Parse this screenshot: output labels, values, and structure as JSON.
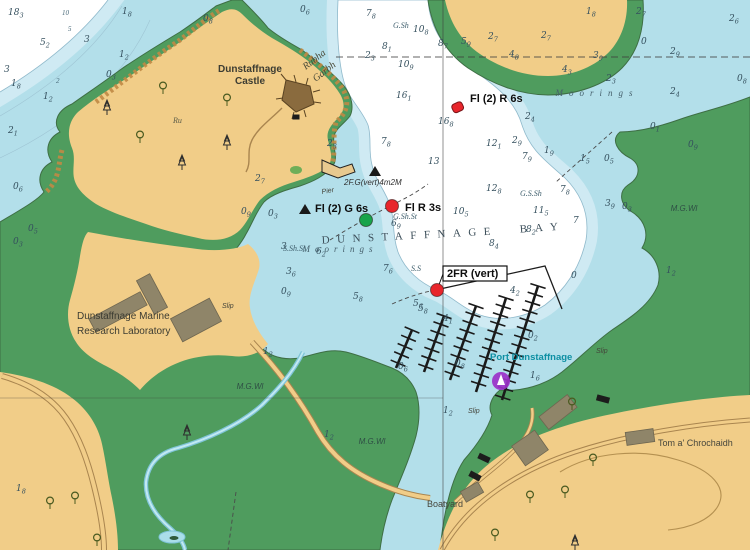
{
  "map": {
    "name": "Dunstaffnage Bay nautical chart",
    "colors": {
      "water_shallow": "#b3dfea",
      "water_band": "#cfeaf3",
      "water_deep": "#ffffff",
      "land_green": "#4f9c5e",
      "land_tan": "#f1cd88",
      "building_grey": "#8f8569",
      "building_black": "#1c1c1c",
      "buoy_red": "#e8262c",
      "buoy_green": "#18a44a",
      "marina_purple": "#9b30c8",
      "port_label_teal": "#0d8fa3",
      "road_brown": "#a9854f",
      "stream_blue": "#7fc4d8"
    },
    "labels": [
      {
        "t": "Dunstaffnage",
        "x": 250,
        "y": 72,
        "cls": "place",
        "anchor": "middle"
      },
      {
        "t": "Castle",
        "x": 250,
        "y": 84,
        "cls": "place",
        "anchor": "middle"
      },
      {
        "t": "Rubha",
        "x": 316,
        "y": 62,
        "cls": "ital",
        "anchor": "middle",
        "rot": -38
      },
      {
        "t": "Garbh",
        "x": 326,
        "y": 74,
        "cls": "ital",
        "anchor": "middle",
        "rot": -38
      },
      {
        "t": "Ru",
        "x": 173,
        "y": 123,
        "cls": "ital-sm"
      },
      {
        "t": "Dunstaffnage Marine",
        "x": 77,
        "y": 319,
        "cls": "place-l"
      },
      {
        "t": "Research Laboratory",
        "x": 77,
        "y": 334,
        "cls": "place-l"
      },
      {
        "t": "Moorings",
        "x": 597,
        "y": 96,
        "cls": "moor",
        "anchor": "middle",
        "ls": 6
      },
      {
        "t": "Moorings",
        "x": 340,
        "y": 252,
        "cls": "moor",
        "anchor": "middle",
        "ls": 5
      },
      {
        "t": "DUNSTAFFNAGE",
        "x": 410,
        "y": 239,
        "cls": "bay",
        "anchor": "middle",
        "ls": 7.5,
        "rot": -3
      },
      {
        "t": "BAY",
        "x": 543,
        "y": 231,
        "cls": "bay",
        "anchor": "middle",
        "ls": 8,
        "rot": -4
      },
      {
        "t": "M.G.Wl",
        "x": 250,
        "y": 389,
        "cls": "note",
        "anchor": "middle"
      },
      {
        "t": "M.G.Wl",
        "x": 372,
        "y": 444,
        "cls": "note",
        "anchor": "middle"
      },
      {
        "t": "M.G.Wl",
        "x": 684,
        "y": 211,
        "cls": "note",
        "anchor": "middle"
      },
      {
        "t": "Slip",
        "x": 222,
        "y": 308,
        "cls": "tiny"
      },
      {
        "t": "Slip",
        "x": 468,
        "y": 413,
        "cls": "tiny"
      },
      {
        "t": "Slip",
        "x": 596,
        "y": 353,
        "cls": "tiny"
      },
      {
        "t": "Boatyard",
        "x": 427,
        "y": 507,
        "cls": "place-s"
      },
      {
        "t": "Tom a' Chrochaidh",
        "x": 658,
        "y": 446,
        "cls": "place-s"
      },
      {
        "t": "Port Dunstaffnage",
        "x": 490,
        "y": 360,
        "cls": "port"
      },
      {
        "t": "Pier",
        "x": 322,
        "y": 194,
        "cls": "tiny",
        "rot": -10
      },
      {
        "t": "2F.G(vert)4m2M",
        "x": 344,
        "y": 185,
        "cls": "lightchar"
      },
      {
        "t": "G.Sh",
        "x": 393,
        "y": 28,
        "cls": "note-i"
      },
      {
        "t": "G.S.Sh",
        "x": 520,
        "y": 196,
        "cls": "note-i"
      },
      {
        "t": "G.Sh.St",
        "x": 393,
        "y": 219,
        "cls": "note-i"
      },
      {
        "t": "S.Sh.St",
        "x": 283,
        "y": 251,
        "cls": "note-i"
      },
      {
        "t": "S.S",
        "x": 411,
        "y": 271,
        "cls": "note-i"
      },
      {
        "t": "10",
        "x": 62,
        "y": 15,
        "cls": "cont"
      },
      {
        "t": "5",
        "x": 68,
        "y": 31,
        "cls": "cont"
      },
      {
        "t": "2",
        "x": 56,
        "y": 83,
        "cls": "cont"
      }
    ],
    "soundings": [
      {
        "x": 8,
        "y": 15,
        "v": "18",
        "s": "3"
      },
      {
        "x": 122,
        "y": 14,
        "v": "1",
        "s": "8"
      },
      {
        "x": 40,
        "y": 45,
        "v": "5",
        "s": "2"
      },
      {
        "x": 84,
        "y": 42,
        "v": "3",
        "s": ""
      },
      {
        "x": 119,
        "y": 57,
        "v": "1",
        "s": "2"
      },
      {
        "x": 4,
        "y": 72,
        "v": "3",
        "s": ""
      },
      {
        "x": 11,
        "y": 86,
        "v": "1",
        "s": "8"
      },
      {
        "x": 106,
        "y": 77,
        "v": "0",
        "s": "3"
      },
      {
        "x": 43,
        "y": 99,
        "v": "1",
        "s": "2"
      },
      {
        "x": 8,
        "y": 133,
        "v": "2",
        "s": "1"
      },
      {
        "x": 13,
        "y": 189,
        "v": "0",
        "s": "6"
      },
      {
        "x": 203,
        "y": 21,
        "v": "0",
        "s": "8"
      },
      {
        "x": 300,
        "y": 12,
        "v": "0",
        "s": "6"
      },
      {
        "x": 366,
        "y": 16,
        "v": "7",
        "s": "8"
      },
      {
        "x": 413,
        "y": 32,
        "v": "10",
        "s": "8"
      },
      {
        "x": 382,
        "y": 49,
        "v": "8",
        "s": "1"
      },
      {
        "x": 365,
        "y": 58,
        "v": "2",
        "s": "3"
      },
      {
        "x": 398,
        "y": 67,
        "v": "10",
        "s": "9"
      },
      {
        "x": 396,
        "y": 98,
        "v": "16",
        "s": "1"
      },
      {
        "x": 438,
        "y": 124,
        "v": "16",
        "s": "8"
      },
      {
        "x": 428,
        "y": 164,
        "v": "13",
        "s": ""
      },
      {
        "x": 486,
        "y": 146,
        "v": "12",
        "s": "1"
      },
      {
        "x": 486,
        "y": 191,
        "v": "12",
        "s": "8"
      },
      {
        "x": 453,
        "y": 214,
        "v": "10",
        "s": "5"
      },
      {
        "x": 586,
        "y": 14,
        "v": "1",
        "s": "8"
      },
      {
        "x": 636,
        "y": 14,
        "v": "2",
        "s": "7"
      },
      {
        "x": 729,
        "y": 21,
        "v": "2",
        "s": "6"
      },
      {
        "x": 255,
        "y": 181,
        "v": "2",
        "s": "7"
      },
      {
        "x": 327,
        "y": 146,
        "v": "2",
        "s": "3"
      },
      {
        "x": 381,
        "y": 144,
        "v": "7",
        "s": "8"
      },
      {
        "x": 438,
        "y": 46,
        "v": "8",
        "s": "7"
      },
      {
        "x": 461,
        "y": 44,
        "v": "5",
        "s": "9"
      },
      {
        "x": 488,
        "y": 39,
        "v": "2",
        "s": "7"
      },
      {
        "x": 541,
        "y": 38,
        "v": "2",
        "s": "7"
      },
      {
        "x": 509,
        "y": 57,
        "v": "4",
        "s": "8"
      },
      {
        "x": 593,
        "y": 58,
        "v": "3",
        "s": "9"
      },
      {
        "x": 670,
        "y": 54,
        "v": "2",
        "s": "9"
      },
      {
        "x": 641,
        "y": 44,
        "v": "0",
        "s": ""
      },
      {
        "x": 562,
        "y": 72,
        "v": "4",
        "s": "3"
      },
      {
        "x": 606,
        "y": 81,
        "v": "2",
        "s": "3"
      },
      {
        "x": 737,
        "y": 81,
        "v": "0",
        "s": "8"
      },
      {
        "x": 670,
        "y": 94,
        "v": "2",
        "s": "4"
      },
      {
        "x": 525,
        "y": 119,
        "v": "2",
        "s": "4"
      },
      {
        "x": 512,
        "y": 143,
        "v": "2",
        "s": "9"
      },
      {
        "x": 544,
        "y": 153,
        "v": "1",
        "s": "9"
      },
      {
        "x": 522,
        "y": 159,
        "v": "7",
        "s": "9"
      },
      {
        "x": 580,
        "y": 161,
        "v": "1",
        "s": "5"
      },
      {
        "x": 604,
        "y": 161,
        "v": "0",
        "s": "5"
      },
      {
        "x": 650,
        "y": 129,
        "v": "0",
        "s": "1"
      },
      {
        "x": 688,
        "y": 147,
        "v": "0",
        "s": "9"
      },
      {
        "x": 560,
        "y": 192,
        "v": "7",
        "s": "8"
      },
      {
        "x": 533,
        "y": 213,
        "v": "11",
        "s": "5"
      },
      {
        "x": 573,
        "y": 223,
        "v": "7",
        "s": ""
      },
      {
        "x": 605,
        "y": 206,
        "v": "3",
        "s": "9"
      },
      {
        "x": 622,
        "y": 209,
        "v": "0",
        "s": "3"
      },
      {
        "x": 526,
        "y": 232,
        "v": "8",
        "s": "2"
      },
      {
        "x": 489,
        "y": 246,
        "v": "8",
        "s": "4"
      },
      {
        "x": 391,
        "y": 226,
        "v": "6",
        "s": "9"
      },
      {
        "x": 316,
        "y": 254,
        "v": "6",
        "s": "2"
      },
      {
        "x": 281,
        "y": 249,
        "v": "3",
        "s": ""
      },
      {
        "x": 286,
        "y": 274,
        "v": "3",
        "s": "6"
      },
      {
        "x": 268,
        "y": 216,
        "v": "0",
        "s": "3"
      },
      {
        "x": 281,
        "y": 294,
        "v": "0",
        "s": "9"
      },
      {
        "x": 353,
        "y": 299,
        "v": "5",
        "s": "8"
      },
      {
        "x": 383,
        "y": 271,
        "v": "7",
        "s": "6"
      },
      {
        "x": 413,
        "y": 306,
        "v": "5",
        "s": "6"
      },
      {
        "x": 510,
        "y": 293,
        "v": "4",
        "s": "2"
      },
      {
        "x": 571,
        "y": 278,
        "v": "0",
        "s": ""
      },
      {
        "x": 666,
        "y": 273,
        "v": "1",
        "s": "2"
      },
      {
        "x": 528,
        "y": 338,
        "v": "0",
        "s": "2"
      },
      {
        "x": 455,
        "y": 366,
        "v": "0",
        "s": "8"
      },
      {
        "x": 398,
        "y": 369,
        "v": "0",
        "s": "6"
      },
      {
        "x": 530,
        "y": 378,
        "v": "1",
        "s": "6"
      },
      {
        "x": 443,
        "y": 413,
        "v": "1",
        "s": "2"
      },
      {
        "x": 418,
        "y": 311,
        "v": "5",
        "s": "8"
      },
      {
        "x": 443,
        "y": 321,
        "v": "4",
        "s": "1"
      },
      {
        "x": 263,
        "y": 354,
        "v": "1",
        "s": "2"
      },
      {
        "x": 324,
        "y": 437,
        "v": "1",
        "s": "2"
      },
      {
        "x": 16,
        "y": 491,
        "v": "1",
        "s": "8"
      },
      {
        "x": 241,
        "y": 214,
        "v": "0",
        "s": "9"
      },
      {
        "x": 13,
        "y": 244,
        "v": "0",
        "s": "3"
      },
      {
        "x": 28,
        "y": 231,
        "v": "0",
        "s": "5"
      }
    ],
    "lights": [
      {
        "label": "Fl (2) R 6s",
        "lx": 470,
        "ly": 102,
        "marker": "can",
        "mx": 457,
        "my": 107,
        "color": "#e8262c"
      },
      {
        "label": "Fl (2) G 6s",
        "lx": 315,
        "ly": 212,
        "marker": "circle",
        "mx": 366,
        "my": 220,
        "color": "#18a44a"
      },
      {
        "label": "Fl R 3s",
        "lx": 405,
        "ly": 211,
        "marker": "circle",
        "mx": 392,
        "my": 206,
        "color": "#e8262c"
      },
      {
        "label": "2FR (vert)",
        "lx": 447,
        "ly": 277,
        "marker": "circle",
        "mx": 437,
        "my": 290,
        "color": "#e8262c",
        "boxed": true
      }
    ],
    "marina": {
      "symbol": "yacht-harbour",
      "sx": 501,
      "sy": 381,
      "combs": [
        [
          412,
          330,
          396,
          368
        ],
        [
          444,
          316,
          424,
          372
        ],
        [
          476,
          306,
          450,
          380
        ],
        [
          506,
          298,
          476,
          392
        ],
        [
          538,
          286,
          502,
          400
        ]
      ]
    },
    "trees": [
      {
        "t": "d",
        "x": 163,
        "y": 88
      },
      {
        "t": "d",
        "x": 227,
        "y": 100
      },
      {
        "t": "d",
        "x": 140,
        "y": 137
      },
      {
        "t": "c",
        "x": 107,
        "y": 108
      },
      {
        "t": "c",
        "x": 182,
        "y": 163
      },
      {
        "t": "c",
        "x": 227,
        "y": 143
      },
      {
        "t": "c",
        "x": 187,
        "y": 433
      },
      {
        "t": "d",
        "x": 50,
        "y": 503
      },
      {
        "t": "d",
        "x": 75,
        "y": 498
      },
      {
        "t": "d",
        "x": 97,
        "y": 540
      },
      {
        "t": "d",
        "x": 572,
        "y": 404
      },
      {
        "t": "d",
        "x": 593,
        "y": 460
      },
      {
        "t": "d",
        "x": 565,
        "y": 492
      },
      {
        "t": "d",
        "x": 530,
        "y": 497
      },
      {
        "t": "d",
        "x": 495,
        "y": 535
      },
      {
        "t": "c",
        "x": 575,
        "y": 543
      }
    ],
    "buildings": [
      {
        "x": 118,
        "y": 312,
        "w": 58,
        "h": 15,
        "r": -28,
        "c": "g"
      },
      {
        "x": 152,
        "y": 294,
        "w": 15,
        "h": 38,
        "r": -28,
        "c": "g"
      },
      {
        "x": 196,
        "y": 320,
        "w": 44,
        "h": 26,
        "r": -28,
        "c": "g"
      },
      {
        "x": 472,
        "y": 492,
        "w": 20,
        "h": 12,
        "r": -30,
        "c": "g"
      },
      {
        "x": 558,
        "y": 412,
        "w": 36,
        "h": 16,
        "r": -38,
        "c": "g"
      },
      {
        "x": 530,
        "y": 448,
        "w": 28,
        "h": 24,
        "r": -35,
        "c": "g"
      },
      {
        "x": 640,
        "y": 437,
        "w": 28,
        "h": 13,
        "r": -8,
        "c": "g"
      },
      {
        "x": 603,
        "y": 399,
        "w": 13,
        "h": 6,
        "r": 15,
        "c": "k"
      },
      {
        "x": 484,
        "y": 458,
        "w": 12,
        "h": 6,
        "r": 25,
        "c": "k"
      },
      {
        "x": 475,
        "y": 476,
        "w": 12,
        "h": 6,
        "r": 28,
        "c": "k"
      },
      {
        "x": 296,
        "y": 117,
        "w": 7,
        "h": 5,
        "r": 0,
        "c": "k"
      }
    ]
  }
}
